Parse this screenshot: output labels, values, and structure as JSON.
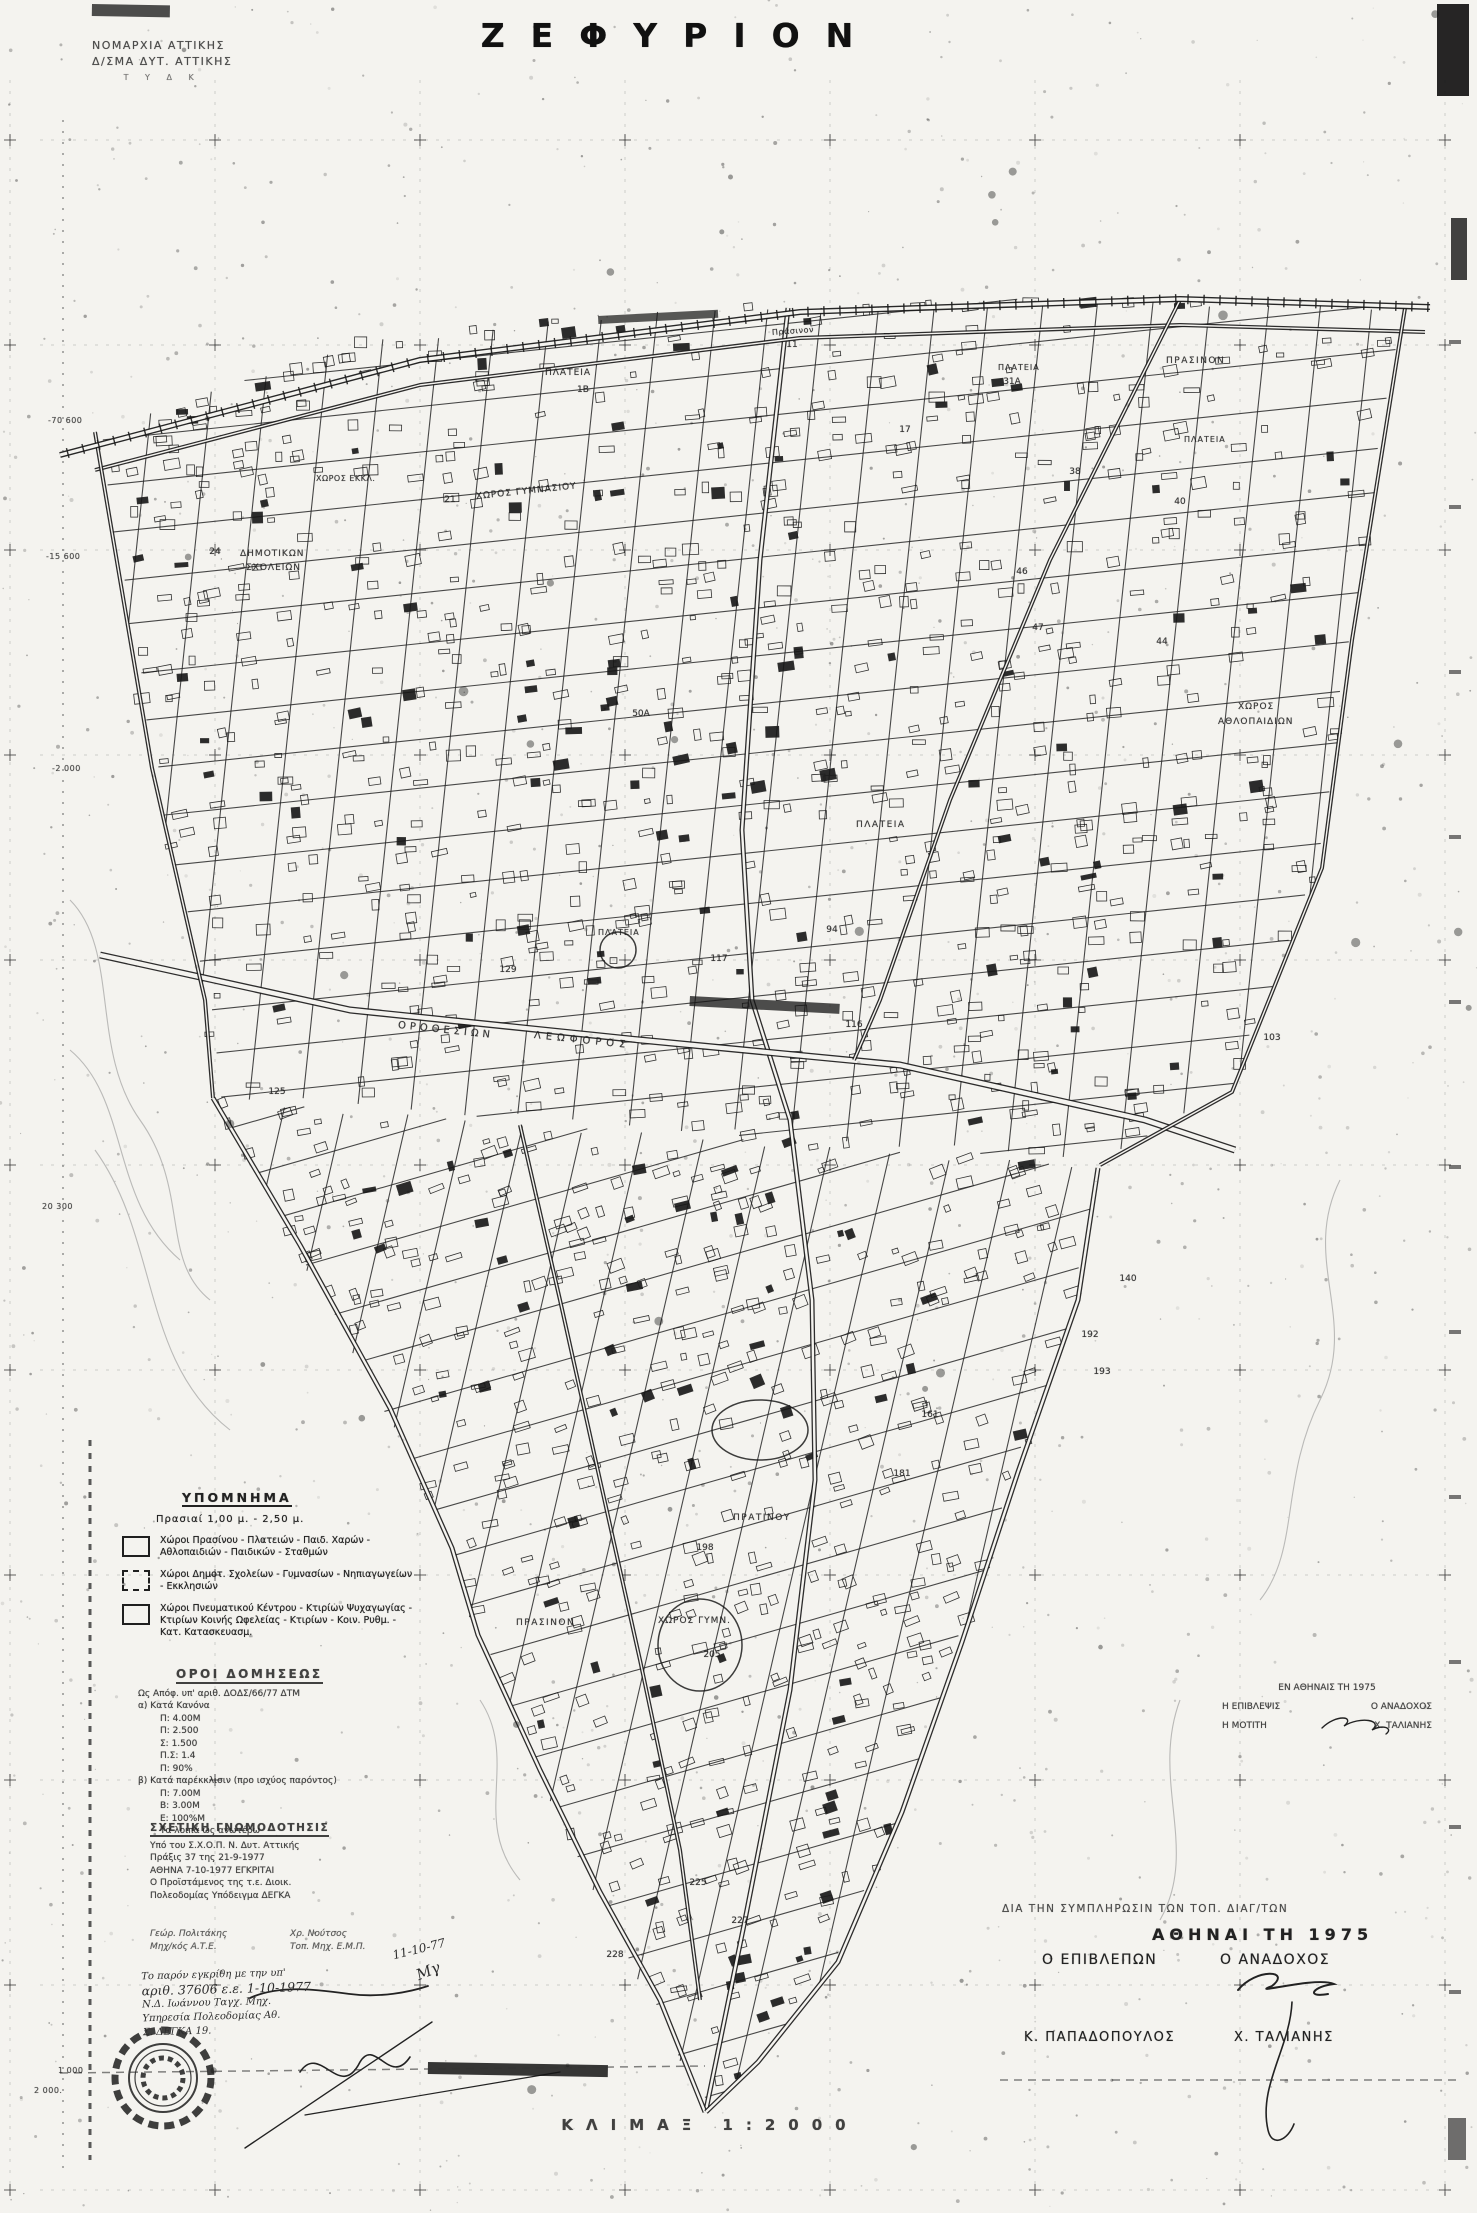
{
  "title": "ΖΕΦΥΡΙΟΝ",
  "agency": {
    "line1": "ΝΟΜΑΡΧΙΑ ΑΤΤΙΚΗΣ",
    "line2": "Δ/ΣΜΑ ΔΥΤ. ΑΤΤΙΚΗΣ",
    "line3": "Τ Υ Δ Κ"
  },
  "legend": {
    "header": "ΥΠΟΜΝΗΜΑ",
    "prasiai": "Πρασιαί  1,00 μ. - 2,50 μ.",
    "items": [
      {
        "text": "Χώροι Πρασίνου - Πλατειών - Παιδ. Χαρών - Αθλοπαιδιών - Παιδικών - Σταθμών",
        "style": "solid"
      },
      {
        "text": "Χώροι Δημοτ. Σχολείων - Γυμνασίων - Νηπιαγωγείων - Εκκλησιών",
        "style": "dash"
      },
      {
        "text": "Χώροι Πνευματικού Κέντρου - Κτιρίων Ψυχαγωγίας - Κτιρίων Κοινής Ωφελείας - Κτιρίων - Κοιν. Ρυθμ. - Κατ. Κατασκευασμ.",
        "style": "solid"
      }
    ]
  },
  "terms": {
    "header": "ΟΡΟΙ ΔΟΜΗΣΕΩΣ",
    "intro": "Ως Απόφ. υπ' αριθ. ΔΟΔΣ/66/77 ΔΤΜ",
    "a_header": "α) Κατά Κανόνα",
    "a_lines": [
      "Π: 4.00Μ",
      "Π: 2.500",
      "Σ: 1.500",
      "Π.Σ: 1.4",
      "Π: 90%"
    ],
    "b_header": "β) Κατά παρέκκλισιν (προ ισχύος παρόντος)",
    "b_lines": [
      "Π: 7.00Μ",
      "Β: 3.00Μ",
      "Ε: 100%Μ",
      "Τα λοιπά ως ανωτέρω"
    ]
  },
  "opinion": {
    "header": "ΣΧΕΤΙΚΗ ΓΝΩΜΟΔΟΤΗΣΙΣ",
    "lines": [
      "Υπό του Σ.Χ.Ο.Π. Ν. Δυτ. Αττικής",
      "Πράξις 37 της 21-9-1977",
      "ΑΘΗΝΑ 7-10-1977      ΕΓΚΡΙΤΑΙ",
      "Ο Προϊστάμενος της τ.ε. Διοικ.",
      "Πολεοδομίας      Υπόδειγμα ΔΕΓΚΑ"
    ],
    "name_left1": "Γεώρ. Πολιτάκης",
    "name_left2": "Μηχ/κός Α.Τ.Ε.",
    "name_right1": "Χρ. Νούτσος",
    "name_right2": "Τοπ. Μηχ. Ε.Μ.Π."
  },
  "fieldsign": {
    "date_line": "ΕΝ ΑΘΗΝΑΙΣ ΤΗ 1975",
    "left_role": "Η ΕΠΙΒΛΕΨΙΣ",
    "left_sub": "Η ΜΟΤΙΤΗ",
    "right_role": "Ο ΑΝΑΔΟΧΟΣ",
    "right_name": "Χ. ΤΑΛΙΑΝΗΣ"
  },
  "signoff": {
    "note": "ΔΙΑ ΤΗΝ ΣΥΜΠΛΗΡΩΣΙΝ ΤΩΝ ΤΟΠ. ΔΙΑΓ/ΤΩΝ",
    "city_date": "ΑΘΗΝΑΙ ΤΗ   1975",
    "left_role": "Ο ΕΠΙΒΛΕΠΩΝ",
    "right_role": "Ο ΑΝΑΔΟΧΟΣ",
    "left_name": "Κ. ΠΑΠΑΔΟΠΟΥΛΟΣ",
    "right_name": "Χ. ΤΑΛΙΑΝΗΣ"
  },
  "handwritten": {
    "line1": "Το παρόν εγκρίθη με την υπ'",
    "line2": "αριθ. 37606 ε.ε. 1-10-1977",
    "line3": "Ν.Δ. Ιωάννου  Ταγχ. Μηχ.",
    "line4": "Υπηρεσία Πολεοδομίας Αθ.",
    "line5": "Σ. ΔΕΓΚΑ  19.",
    "corner_date": "11-10-77",
    "corner_initials": "Μγ"
  },
  "scale_label": "ΚΛΙΜΑΞ  1:2000",
  "grid_labels": [
    {
      "text": "-70 600",
      "x": 48,
      "y": 416
    },
    {
      "text": "-15 600",
      "x": 46,
      "y": 552
    },
    {
      "text": "-2 000",
      "x": 52,
      "y": 764
    },
    {
      "text": "20 300",
      "x": 42,
      "y": 1202
    },
    {
      "text": "1 000",
      "x": 58,
      "y": 2066
    },
    {
      "text": "2 000.",
      "x": 34,
      "y": 2086
    }
  ],
  "area_labels": [
    {
      "text": "ΠΛΑΤΕΙΑ",
      "x": 545,
      "y": 368,
      "rot": 0,
      "size": 9,
      "ls": 1
    },
    {
      "text": "Πράσινον",
      "x": 772,
      "y": 328,
      "rot": -4,
      "size": 8,
      "ls": 0.5
    },
    {
      "text": "ΠΛΑΤΕΙΑ",
      "x": 998,
      "y": 363,
      "rot": 0,
      "size": 8,
      "ls": 1
    },
    {
      "text": "ΠΡΑΣΙΝΟΝ",
      "x": 1166,
      "y": 356,
      "rot": 0,
      "size": 9,
      "ls": 1.5
    },
    {
      "text": "ΠΛΑΤΕΙΑ",
      "x": 1184,
      "y": 435,
      "rot": 0,
      "size": 8,
      "ls": 1
    },
    {
      "text": "ΧΩΡΟΣ ΓΥΜΝΑΣΙΟΥ",
      "x": 476,
      "y": 492,
      "rot": -6,
      "size": 9,
      "ls": 1
    },
    {
      "text": "ΧΩΡΟΣ ΕΚΚΛ.",
      "x": 316,
      "y": 474,
      "rot": 0,
      "size": 8,
      "ls": 0.5
    },
    {
      "text": "ΔΗΜΟΤΙΚΩΝ",
      "x": 240,
      "y": 549,
      "rot": 0,
      "size": 9,
      "ls": 1
    },
    {
      "text": "ΣΧΟΛΕΙΩΝ",
      "x": 246,
      "y": 563,
      "rot": 0,
      "size": 9,
      "ls": 1
    },
    {
      "text": "ΧΩΡΟΣ",
      "x": 1238,
      "y": 702,
      "rot": 0,
      "size": 9,
      "ls": 1
    },
    {
      "text": "ΑΘΛΟΠΑΙΔΙΩΝ",
      "x": 1218,
      "y": 717,
      "rot": 0,
      "size": 9,
      "ls": 1
    },
    {
      "text": "ΠΛΑΤΕΙΑ",
      "x": 856,
      "y": 820,
      "rot": 0,
      "size": 9,
      "ls": 1.5
    },
    {
      "text": "ΠΛΑΤΕΙΑ",
      "x": 598,
      "y": 928,
      "rot": 0,
      "size": 8,
      "ls": 1
    },
    {
      "text": "ΟΡΟΘΕΣΙΩΝ",
      "x": 398,
      "y": 1020,
      "rot": 6,
      "size": 10,
      "ls": 4
    },
    {
      "text": "ΛΕΩΦΟΡΟΣ",
      "x": 534,
      "y": 1030,
      "rot": 6,
      "size": 10,
      "ls": 5
    },
    {
      "text": "ΠΡΑΤΙΝΟΥ",
      "x": 733,
      "y": 1513,
      "rot": 0,
      "size": 9,
      "ls": 1.5
    },
    {
      "text": "ΠΡΑΣΙΝΟΝ",
      "x": 516,
      "y": 1618,
      "rot": 0,
      "size": 9,
      "ls": 1.5
    },
    {
      "text": "ΧΩΡΟΣ ΓΥΜΝ.",
      "x": 658,
      "y": 1616,
      "rot": 0,
      "size": 9,
      "ls": 1
    }
  ],
  "block_numbers": [
    {
      "n": "11",
      "x": 792,
      "y": 345
    },
    {
      "n": "1Β",
      "x": 583,
      "y": 390
    },
    {
      "n": "31Α",
      "x": 1012,
      "y": 382
    },
    {
      "n": "21",
      "x": 450,
      "y": 500
    },
    {
      "n": "24",
      "x": 215,
      "y": 552
    },
    {
      "n": "17",
      "x": 905,
      "y": 430
    },
    {
      "n": "38",
      "x": 1075,
      "y": 472
    },
    {
      "n": "40",
      "x": 1180,
      "y": 502
    },
    {
      "n": "46",
      "x": 1022,
      "y": 572
    },
    {
      "n": "47",
      "x": 1038,
      "y": 628
    },
    {
      "n": "44",
      "x": 1162,
      "y": 642
    },
    {
      "n": "50Α",
      "x": 641,
      "y": 714
    },
    {
      "n": "94",
      "x": 832,
      "y": 930
    },
    {
      "n": "117",
      "x": 719,
      "y": 959
    },
    {
      "n": "129",
      "x": 508,
      "y": 970
    },
    {
      "n": "116",
      "x": 854,
      "y": 1025
    },
    {
      "n": "125",
      "x": 277,
      "y": 1092
    },
    {
      "n": "103",
      "x": 1272,
      "y": 1038
    },
    {
      "n": "140",
      "x": 1128,
      "y": 1279
    },
    {
      "n": "192",
      "x": 1090,
      "y": 1335
    },
    {
      "n": "193",
      "x": 1102,
      "y": 1372
    },
    {
      "n": "181",
      "x": 902,
      "y": 1474
    },
    {
      "n": "161",
      "x": 930,
      "y": 1415
    },
    {
      "n": "198",
      "x": 705,
      "y": 1548
    },
    {
      "n": "205",
      "x": 712,
      "y": 1655
    },
    {
      "n": "225",
      "x": 698,
      "y": 1883
    },
    {
      "n": "227",
      "x": 740,
      "y": 1921
    },
    {
      "n": "228",
      "x": 615,
      "y": 1955
    }
  ],
  "map": {
    "width": 1477,
    "height": 2213,
    "seed": 7,
    "colors": {
      "paper": "#f4f3ef",
      "ink": "#1b1b1b",
      "mid": "#333333",
      "light": "#8a8a8a"
    },
    "grid": {
      "x0": 10,
      "y0": 140,
      "spacing": 205
    },
    "boundary_upper": [
      [
        95,
        432
      ],
      [
        360,
        340
      ],
      [
        700,
        305
      ],
      [
        1080,
        298
      ],
      [
        1405,
        306
      ],
      [
        1352,
        640
      ],
      [
        1322,
        868
      ],
      [
        1232,
        1092
      ],
      [
        1100,
        1163
      ],
      [
        520,
        1120
      ],
      [
        215,
        1098
      ],
      [
        205,
        1000
      ],
      [
        152,
        768
      ]
    ],
    "boundary_lower": [
      [
        215,
        1100
      ],
      [
        520,
        1122
      ],
      [
        900,
        1150
      ],
      [
        1098,
        1166
      ],
      [
        1078,
        1300
      ],
      [
        1018,
        1472
      ],
      [
        962,
        1642
      ],
      [
        902,
        1812
      ],
      [
        838,
        1962
      ],
      [
        758,
        2062
      ],
      [
        706,
        2112
      ],
      [
        635,
        1975
      ],
      [
        575,
        1860
      ],
      [
        520,
        1740
      ],
      [
        470,
        1620
      ],
      [
        445,
        1540
      ],
      [
        375,
        1395
      ],
      [
        290,
        1240
      ]
    ],
    "families": [
      {
        "region": "upper",
        "angle": 96,
        "spacing": 55
      },
      {
        "region": "upper",
        "angle": -6,
        "spacing": 47
      },
      {
        "region": "lower",
        "angle": 103,
        "spacing": 60
      },
      {
        "region": "lower",
        "angle": -16,
        "spacing": 52
      }
    ],
    "buildings": {
      "upper": 950,
      "lower": 820
    },
    "speckles": 1500,
    "railway": [
      [
        60,
        455
      ],
      [
        420,
        360
      ],
      [
        800,
        312
      ],
      [
        1180,
        299
      ],
      [
        1430,
        307
      ]
    ],
    "roads": [
      {
        "w": 5,
        "pts": [
          [
            788,
            308
          ],
          [
            760,
            560
          ],
          [
            742,
            830
          ],
          [
            752,
            1000
          ],
          [
            790,
            1120
          ],
          [
            812,
            1300
          ],
          [
            815,
            1480
          ],
          [
            790,
            1690
          ],
          [
            745,
            1920
          ],
          [
            706,
            2110
          ]
        ]
      },
      {
        "w": 7,
        "pts": [
          [
            100,
            955
          ],
          [
            350,
            1010
          ],
          [
            640,
            1040
          ],
          [
            900,
            1065
          ],
          [
            1145,
            1120
          ],
          [
            1235,
            1150
          ]
        ]
      },
      {
        "w": 4,
        "pts": [
          [
            95,
            470
          ],
          [
            420,
            385
          ],
          [
            800,
            338
          ],
          [
            1180,
            325
          ],
          [
            1425,
            332
          ]
        ]
      },
      {
        "w": 5,
        "pts": [
          [
            213,
            1098
          ],
          [
            300,
            1245
          ],
          [
            390,
            1408
          ],
          [
            452,
            1548
          ],
          [
            478,
            1635
          ],
          [
            540,
            1770
          ],
          [
            600,
            1892
          ],
          [
            660,
            2000
          ],
          [
            705,
            2112
          ]
        ]
      },
      {
        "w": 5,
        "pts": [
          [
            1098,
            1168
          ],
          [
            1078,
            1300
          ],
          [
            1018,
            1472
          ],
          [
            962,
            1642
          ],
          [
            902,
            1812
          ],
          [
            838,
            1962
          ],
          [
            758,
            2062
          ],
          [
            706,
            2112
          ]
        ]
      },
      {
        "w": 4,
        "pts": [
          [
            1405,
            308
          ],
          [
            1352,
            640
          ],
          [
            1322,
            868
          ],
          [
            1232,
            1092
          ],
          [
            1100,
            1165
          ]
        ]
      },
      {
        "w": 4,
        "pts": [
          [
            95,
            432
          ],
          [
            152,
            768
          ],
          [
            205,
            1000
          ],
          [
            213,
            1098
          ]
        ]
      },
      {
        "w": 4,
        "pts": [
          [
            1180,
            300
          ],
          [
            1050,
            560
          ],
          [
            950,
            800
          ],
          [
            880,
            1000
          ],
          [
            854,
            1060
          ]
        ]
      },
      {
        "w": 4,
        "pts": [
          [
            520,
            1125
          ],
          [
            560,
            1300
          ],
          [
            600,
            1480
          ],
          [
            640,
            1660
          ],
          [
            680,
            1850
          ],
          [
            700,
            2000
          ]
        ]
      }
    ],
    "features": [
      {
        "type": "ellipse",
        "cx": 760,
        "cy": 1430,
        "rx": 48,
        "ry": 30
      },
      {
        "type": "circle",
        "cx": 618,
        "cy": 950,
        "r": 18
      },
      {
        "type": "ellipse",
        "cx": 700,
        "cy": 1645,
        "rx": 42,
        "ry": 46
      }
    ],
    "seal": {
      "cx": 163,
      "cy": 2078,
      "r": 48
    },
    "signatures": [
      {
        "d": "M1322,1728 c14,-14 34,-12 22,-2 c16,-10 40,-6 28,4 c10,-6 22,-2 14,4",
        "w": 1.4
      },
      {
        "d": "M1238,1990 c18,-22 54,-20 34,-4 c-26,10 44,-10 62,-2 c-20,2 -30,14 -6,10",
        "w": 2
      },
      {
        "d": "M1292,2002 c-2,46 -34,84 -24,128 c4,18 20,10 26,-6",
        "w": 1.6
      },
      {
        "d": "M300,2072 c20,-30 40,30 60,-10 c15,-25 30,25 50,-5",
        "w": 1.6
      },
      {
        "d": "M245,2148 L432,2022",
        "w": 1.4
      },
      {
        "d": "M305,2115 L560,2072",
        "w": 1.2
      },
      {
        "d": "M250,1998 c30,-14 70,-8 100,-4 c30,4 60,-2 78,-8",
        "w": 1.8
      }
    ],
    "artifacts": [
      {
        "x": 1437,
        "y": 4,
        "w": 32,
        "h": 92,
        "op": 0.92,
        "rot": 0
      },
      {
        "x": 1451,
        "y": 218,
        "w": 16,
        "h": 62,
        "op": 0.8,
        "rot": 0
      },
      {
        "x": 92,
        "y": 4,
        "w": 78,
        "h": 12,
        "op": 0.75,
        "rot": 1
      },
      {
        "x": 1448,
        "y": 2118,
        "w": 18,
        "h": 42,
        "op": 0.6,
        "rot": 0
      },
      {
        "x": 428,
        "y": 2062,
        "w": 180,
        "h": 12,
        "op": 0.85,
        "rot": 1
      },
      {
        "x": 598,
        "y": 316,
        "w": 120,
        "h": 8,
        "op": 0.7,
        "rot": -3
      },
      {
        "x": 690,
        "y": 996,
        "w": 150,
        "h": 10,
        "op": 0.75,
        "rot": 3
      }
    ],
    "extra_dashed": [
      {
        "x1": 90,
        "y1": 1440,
        "x2": 90,
        "y2": 2160,
        "w": 3,
        "dash": "6 7",
        "op": 0.8
      },
      {
        "x1": 63,
        "y1": 120,
        "x2": 63,
        "y2": 2170,
        "w": 1.5,
        "dash": "2 9",
        "op": 0.5
      },
      {
        "x1": 60,
        "y1": 2073,
        "x2": 705,
        "y2": 2066,
        "w": 1.5,
        "dash": "8 6",
        "op": 0.6
      },
      {
        "x1": 1000,
        "y1": 2080,
        "x2": 1460,
        "y2": 2080,
        "w": 1.5,
        "dash": "8 6",
        "op": 0.6
      }
    ],
    "contours": [
      "M70,900 C120,950 90,1050 140,1120 S160,1260 210,1300",
      "M70,1050 C130,1100 110,1200 180,1260",
      "M1340,1180 C1300,1260 1360,1320 1320,1400 S1300,1550 1260,1600",
      "M480,1700 C520,1760 470,1820 520,1880",
      "M1180,1700 C1150,1780 1200,1850 1160,1920",
      "M95,1150 C160,1240 140,1360 230,1430"
    ]
  }
}
